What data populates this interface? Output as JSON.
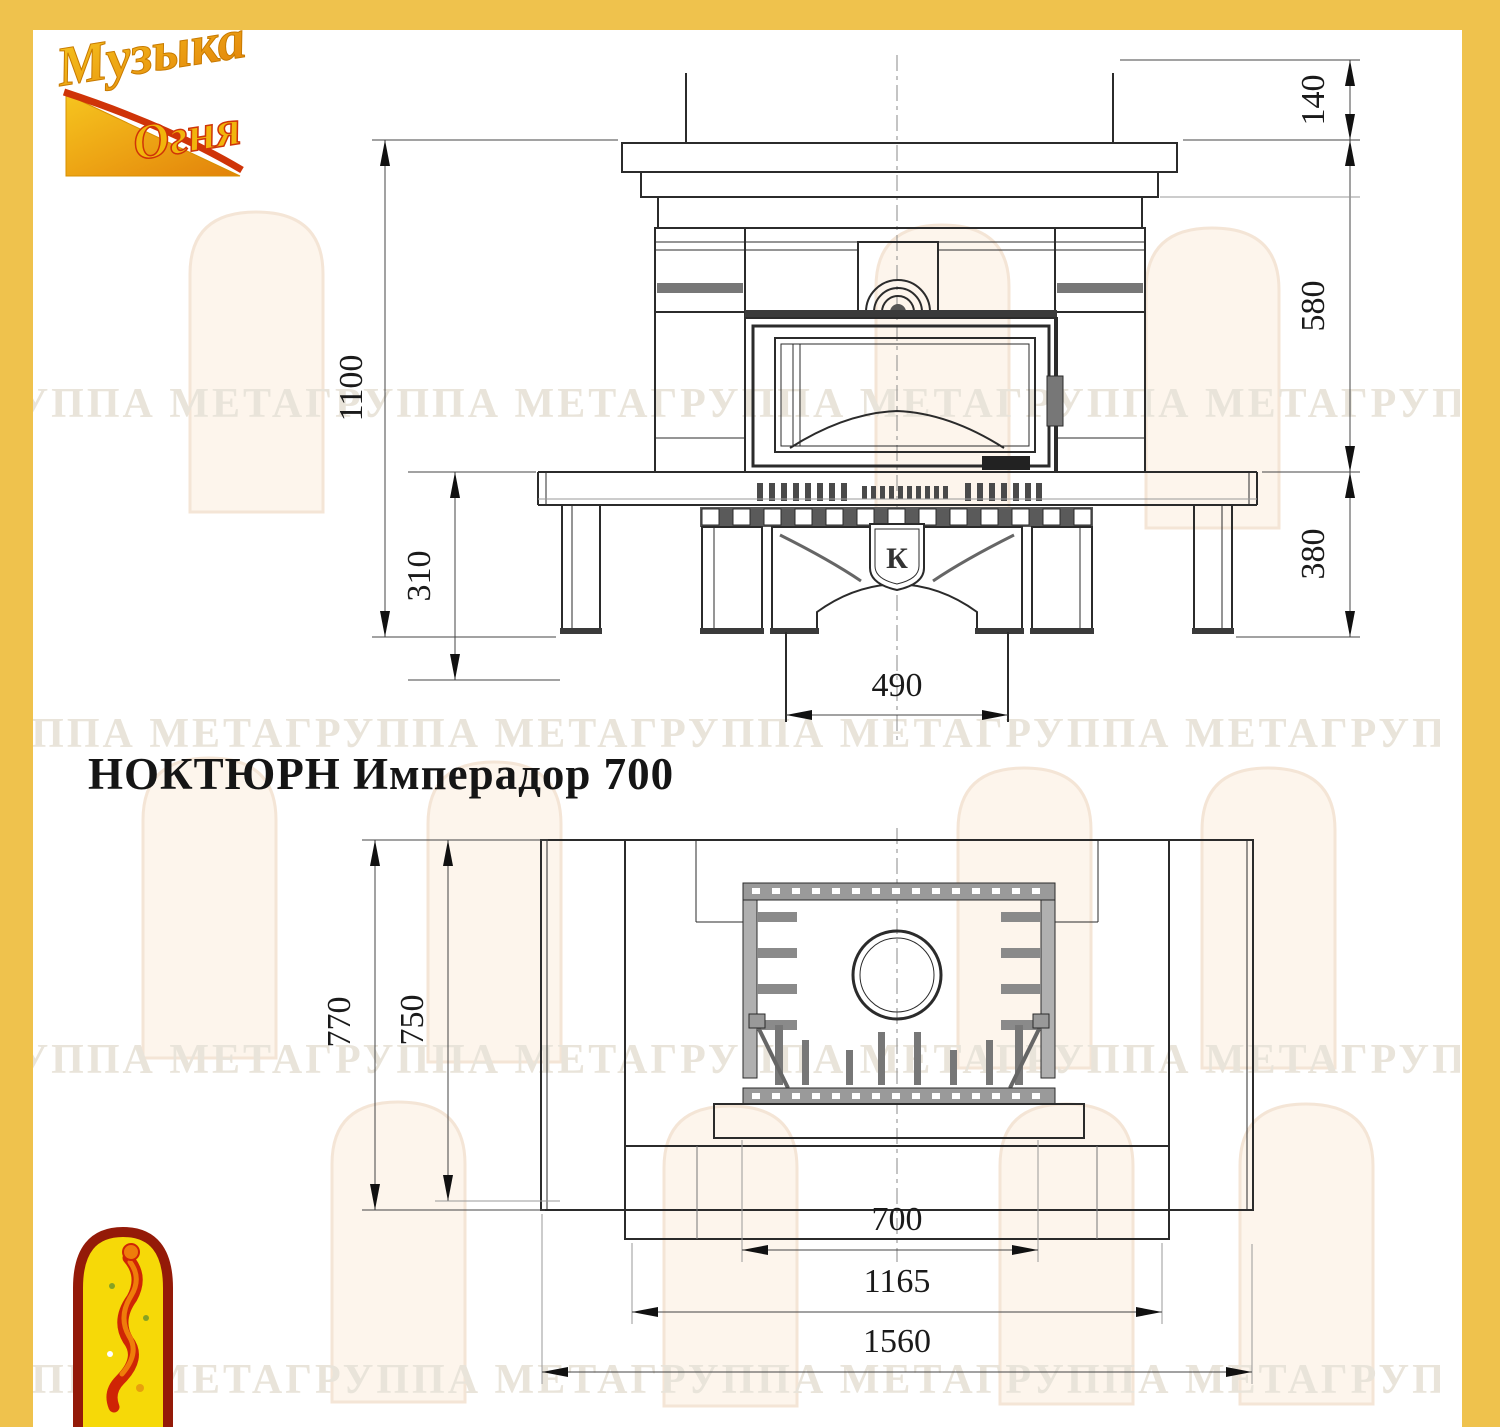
{
  "page": {
    "border_color": "#efc24d",
    "paper_color": "#ffffff",
    "line_color": "#2b2b2b"
  },
  "logo": {
    "word1": "Музыка",
    "word2": "Огня"
  },
  "title": "НОКТЮРН Имперадор 700",
  "watermark_text": "ГРУППА МЕТАГРУППА МЕТАГРУППА МЕТАГРУППА МЕТАГРУППА МЕТА",
  "front_view": {
    "shield_letter": "К",
    "dims": {
      "total_height": "1100",
      "hearth": "310",
      "pedestal": "490",
      "top": "140",
      "middle": "580",
      "bottom": "380"
    }
  },
  "plan_view": {
    "dims": {
      "depth": "770",
      "inner_depth": "750",
      "opening": "700",
      "body": "1165",
      "width": "1560"
    }
  }
}
